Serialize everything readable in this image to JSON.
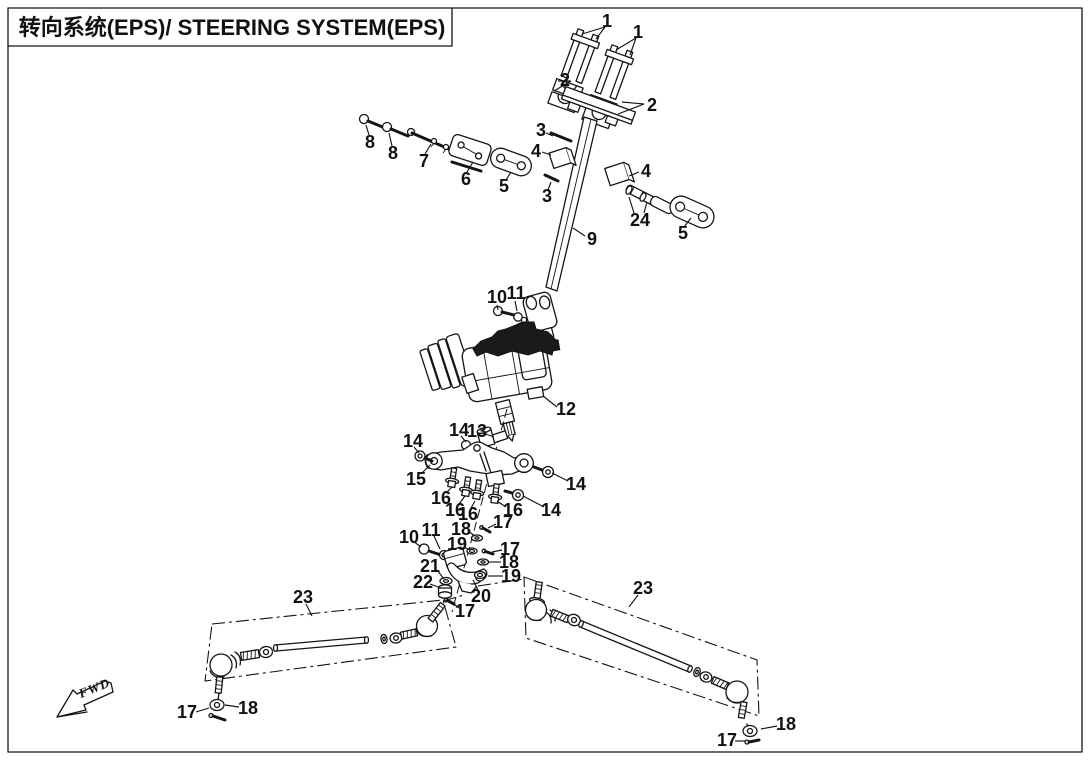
{
  "header": {
    "title": "转向系统(EPS)/ STEERING SYSTEM(EPS)"
  },
  "fwd": {
    "label": "FWD"
  },
  "parts": {
    "p1": "1",
    "p2": "2",
    "p3": "3",
    "p4": "4",
    "p5": "5",
    "p6": "6",
    "p7": "7",
    "p8": "8",
    "p9": "9",
    "p10": "10",
    "p11": "11",
    "p12": "12",
    "p13": "13",
    "p14": "14",
    "p15": "15",
    "p16": "16",
    "p17": "17",
    "p18": "18",
    "p19": "19",
    "p20": "20",
    "p21": "21",
    "p22": "22",
    "p23": "23",
    "p24": "24"
  }
}
